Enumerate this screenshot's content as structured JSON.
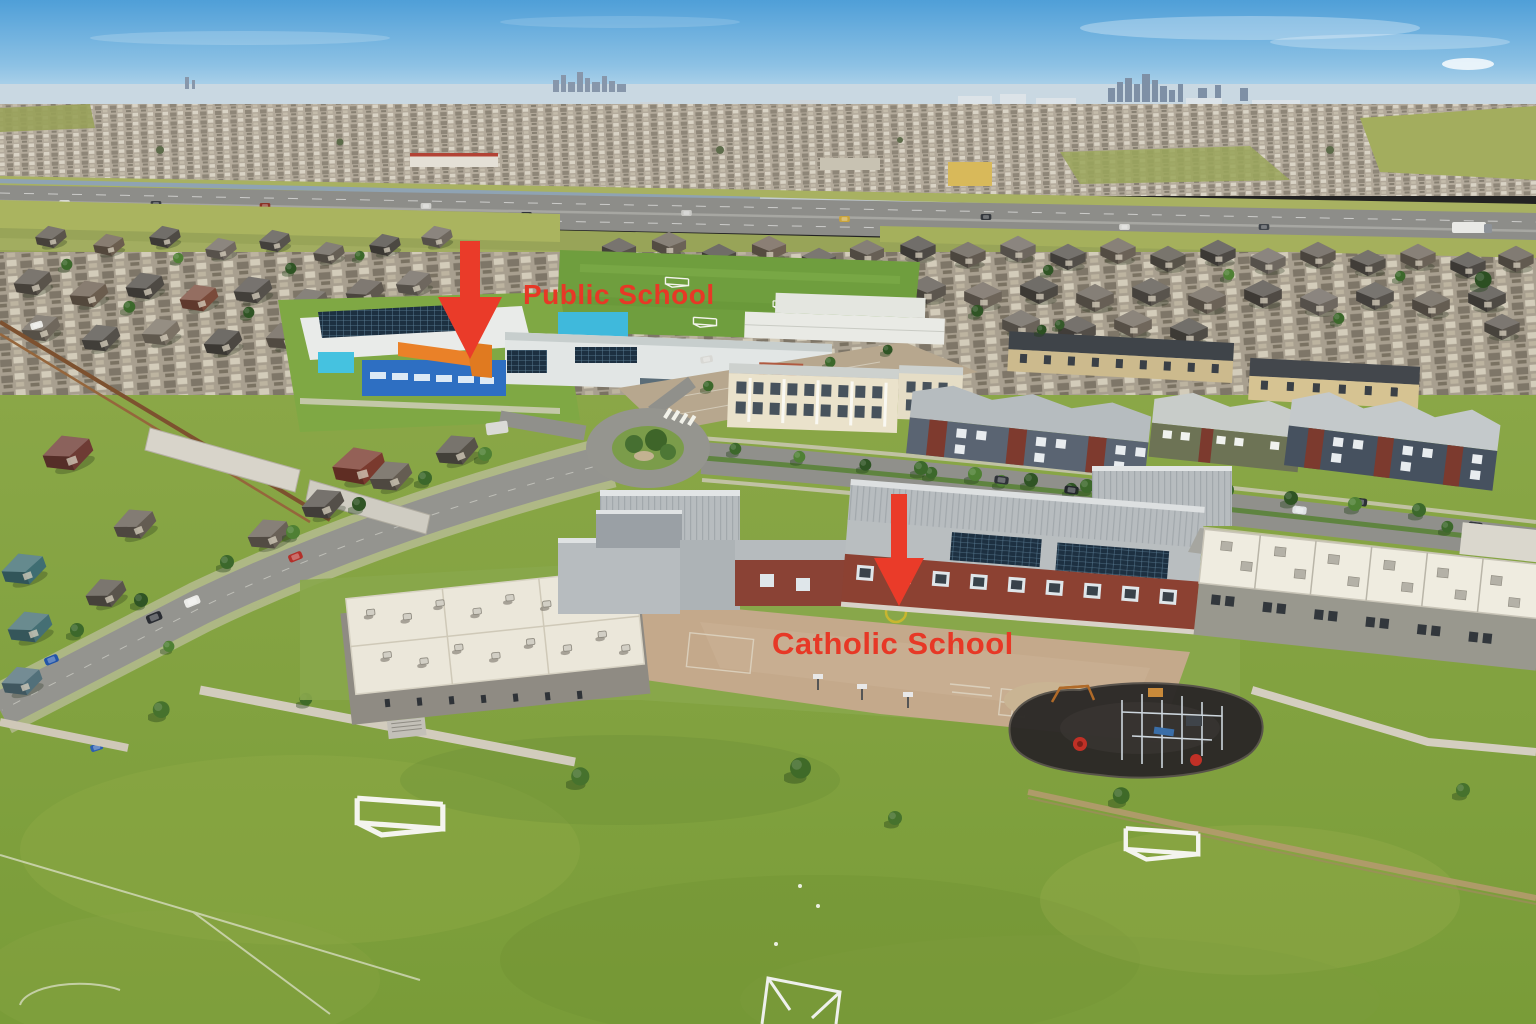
{
  "image": {
    "description": "Aerial drone photo of a suburban neighbourhood; a modern blue-and-orange public school and a large brick-and-grey catholic school with portable classrooms, playground and sports fields, houses, a roundabout and a highway with a distant city skyline on the horizon",
    "width": 1536,
    "height": 1024
  },
  "annotations": {
    "arrow_color": "#ea3b29",
    "text_color": "#e73826",
    "labels": [
      {
        "id": "public-school",
        "text": "Public School"
      },
      {
        "id": "catholic-school",
        "text": "Catholic School"
      }
    ]
  },
  "palette": {
    "sky_top": "#4f9fd8",
    "sky_horizon": "#d7e7f0",
    "field_green": "#7fa03c",
    "road_gray": "#94948f",
    "school_blue": "#2e6fc2",
    "school_cyan": "#41bcdc",
    "school_orange": "#ea8128",
    "brick_red": "#8c4132",
    "tarmac_tan": "#c2a88a",
    "playground_surface": "#2c2927",
    "portable_roof": "#ebe7da"
  }
}
